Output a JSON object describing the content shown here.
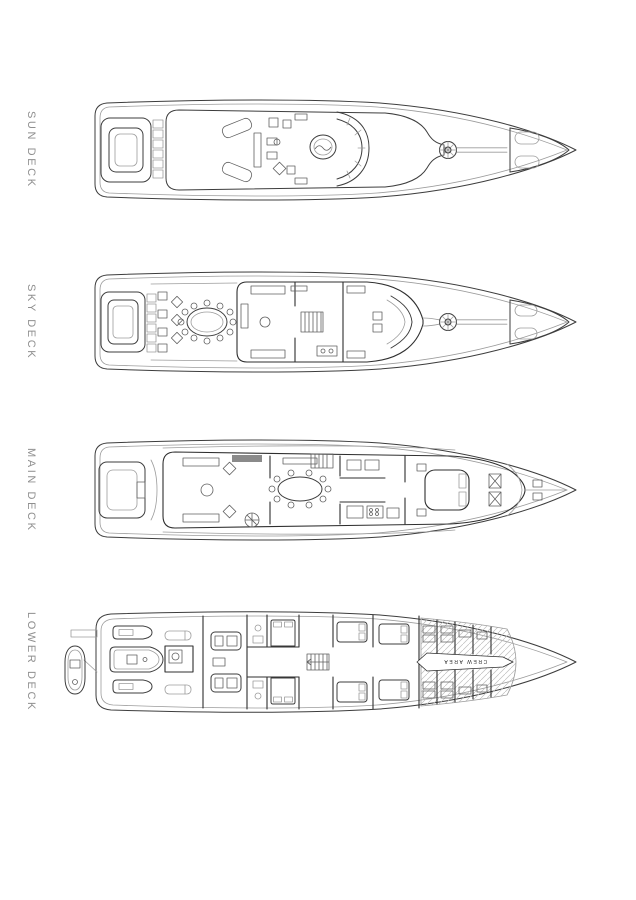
{
  "decks": [
    {
      "id": "sun-deck",
      "label": "SUN DECK"
    },
    {
      "id": "sky-deck",
      "label": "SKY DECK"
    },
    {
      "id": "main-deck",
      "label": "MAIN DECK"
    },
    {
      "id": "lower-deck",
      "label": "LOWER DECK",
      "annotation": "CREW AREA"
    }
  ],
  "colors": {
    "line": "#3d3d3d",
    "soft": "#9c9c9c",
    "wall": "#2f2f2f",
    "furn": "#606060",
    "dark": "#8a8a8a",
    "hatch": "#bdbdbd",
    "label": "#8f8f8f",
    "background": "#ffffff"
  }
}
